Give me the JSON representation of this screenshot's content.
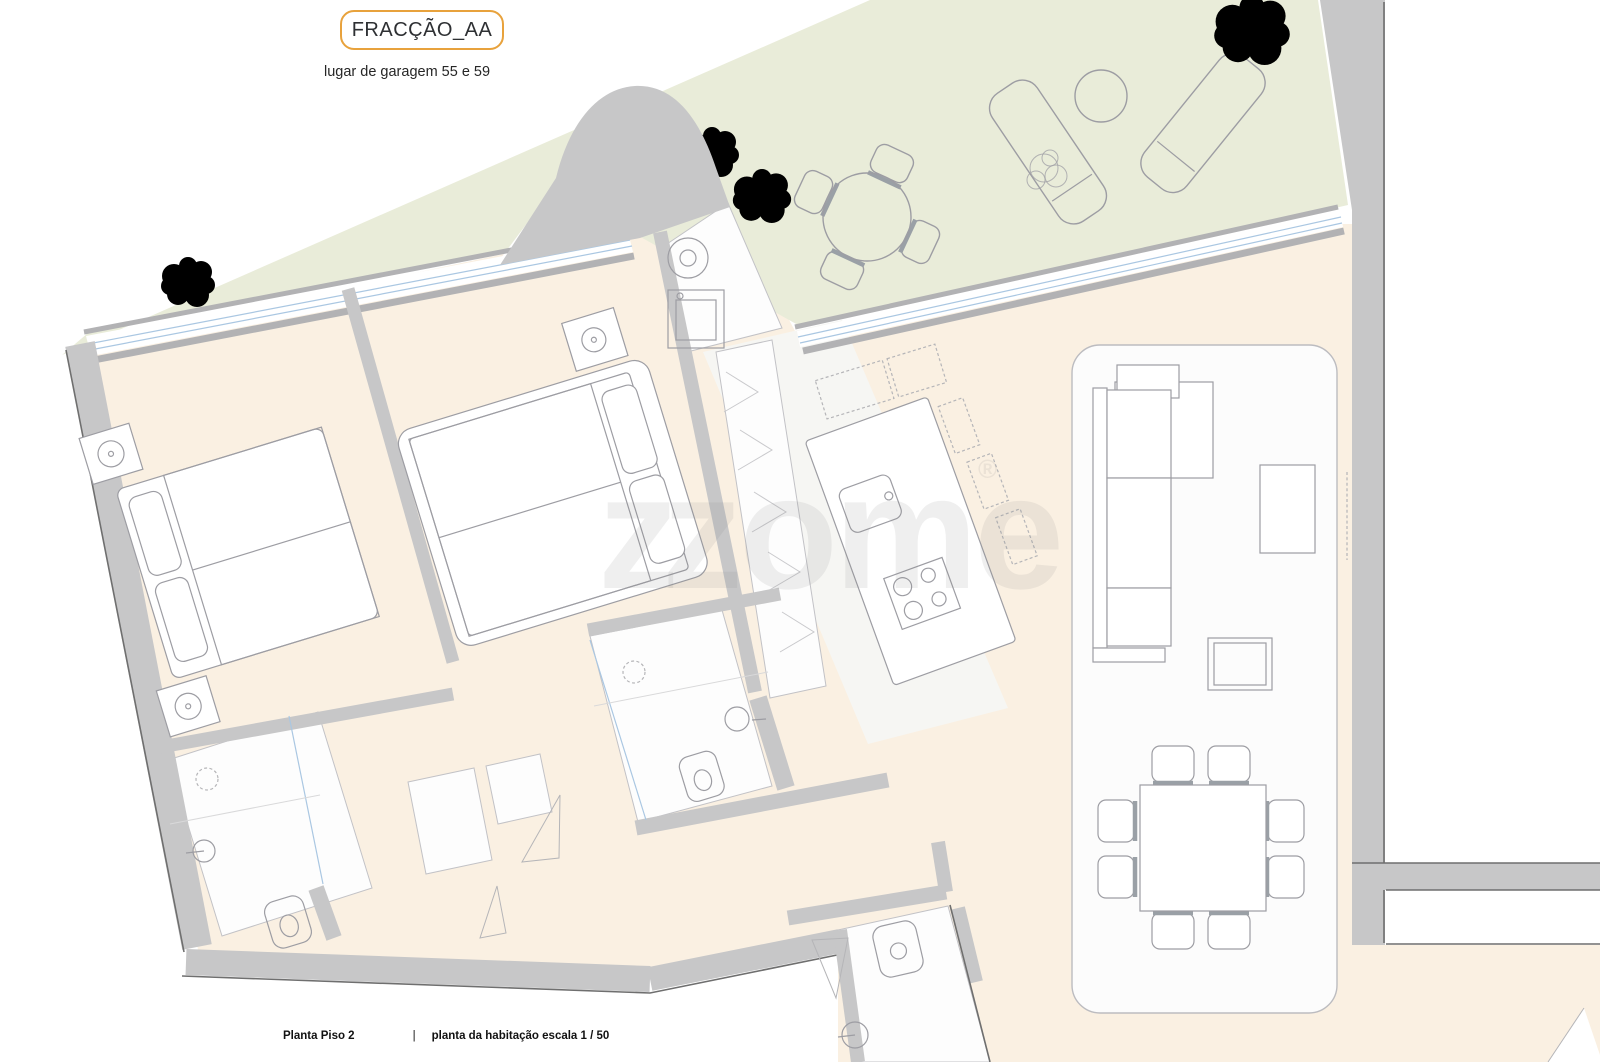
{
  "header": {
    "fraction_label": "FRACÇÃO_AA",
    "garage_note": "lugar de garagem 55 e 59"
  },
  "footer": {
    "plan_name": "Planta Piso 2",
    "separator": "|",
    "scale_note": "planta da habitação escala 1 / 50"
  },
  "watermark": {
    "mark": "z",
    "text": "zome",
    "registered": "®"
  },
  "colors": {
    "accent_orange": "#e8a23c",
    "terrace_green": "#e9ecd9",
    "floor_cream": "#faf0e2",
    "wall_gray": "#c7c7c8",
    "wall_dark": "#6f6f6f",
    "window_blue": "#aac7e2",
    "furniture_line": "#9d9da3",
    "tree_green": "#98ad62",
    "text_dark": "#2e3033"
  }
}
